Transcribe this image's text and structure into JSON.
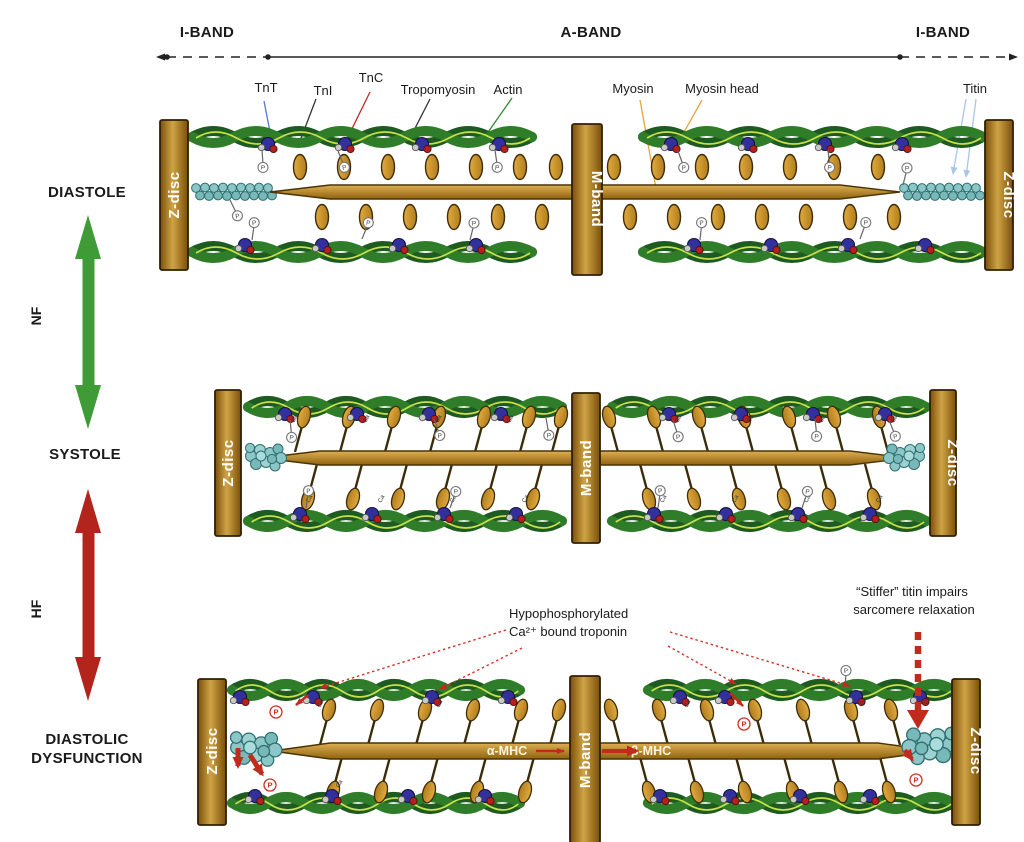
{
  "figure": {
    "bands": {
      "i_band_left": "I-BAND",
      "a_band": "A-BAND",
      "i_band_right": "I-BAND"
    },
    "molecules": {
      "tnt": "TnT",
      "tni": "TnI",
      "tnc": "TnC",
      "tropomyosin": "Tropomyosin",
      "actin": "Actin",
      "myosin": "Myosin",
      "myosin_head": "Myosin head",
      "titin": "Titin"
    },
    "states": {
      "diastole": "DIASTOLE",
      "systole": "SYSTOLE",
      "dysfunction_line1": "DIASTOLIC",
      "dysfunction_line2": "DYSFUNCTION"
    },
    "condition_arrows": {
      "normal": "NF",
      "failure": "HF"
    },
    "structures": {
      "z_disc": "Z-disc",
      "m_band": "M-band"
    },
    "annotations": {
      "hypophosphorylated_line1": "Hypophosphorylated",
      "hypophosphorylated_line2": "Ca²⁺ bound troponin",
      "stiffer_titin_line1": "“Stiffer” titin impairs",
      "stiffer_titin_line2": "sarcomere relaxation",
      "alpha_mhc": "α-MHC",
      "beta_mhc": "β-MHC",
      "phosphate_symbol": "P",
      "calcium_symbol": "Ca"
    },
    "colors": {
      "nf_arrow_green": "#3e9b35",
      "hf_arrow_red": "#b3251c",
      "z_disc_gold": "#c79b3a",
      "myosin_gold": "#c0892b",
      "actin_green": "#2f7d29",
      "tropomyosin_yellow": "#c8e04a",
      "troponin_blue": "#32309c",
      "titin_teal": "#8cc6c6",
      "tnt_line_blue": "#5577cc",
      "tnc_line_red": "#cc2222",
      "myosin_line_orange": "#e8a33a",
      "titin_line_lightblue": "#a9c6e8"
    }
  }
}
